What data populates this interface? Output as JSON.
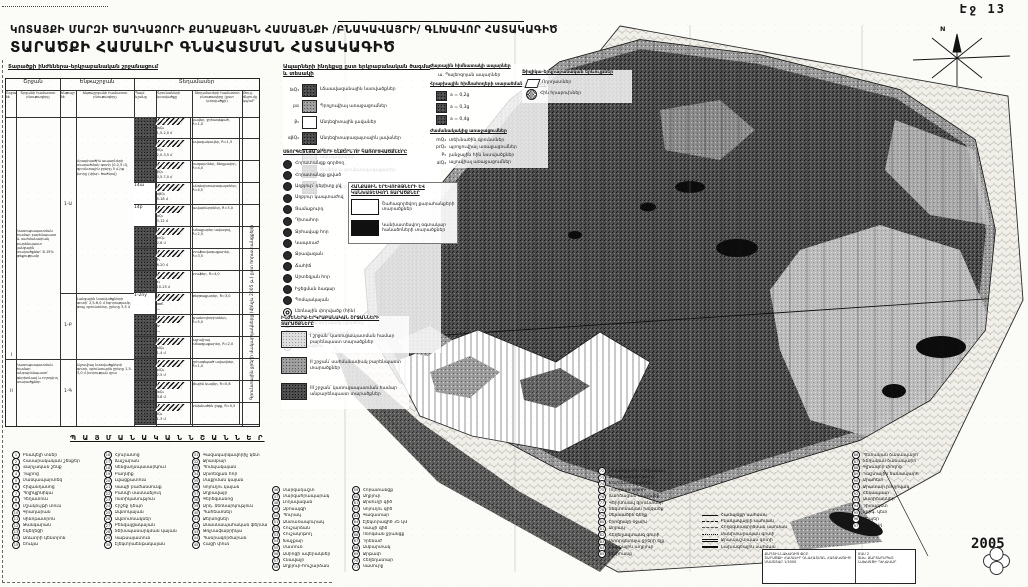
{
  "page": {
    "label": "Էջ 13",
    "year": "2005"
  },
  "header": {
    "line1": "ԿՈՏԱՅՔԻ ՄԱՐԶԻ ԾԱՂԿԱՁՈՐԻ ՔԱՂԱՔԱՅԻՆ ՀԱՄԱՅՆՔԻ /ԲՆԱԿԱՎԱՅՐԻ/ ԳԼԽԱՎՈՐ ՀԱՏԱԿԱԳԻԾ",
    "line2": "ՏԱՐԱԾՔԻ ՀԱՄԱԼԻՐ ԳՆԱՀԱՏՄԱՆ ՀԱՏԱԿԱԳԻԾ"
  },
  "table": {
    "title": "Տարածքի ինժեներա-երկրաբանական շրջանացում",
    "groups": [
      "Շրջան",
      "Ենթաշրջան",
      "Տեղամասեր"
    ],
    "cols": [
      "Շրջանի №",
      "Շրջանի համառոտ բնութագիրը",
      "Ենթաշրջանի №",
      "Ենթաշրջանի համառոտ բնութագիրը",
      "Պայմ. նշանը",
      "Գրունտների կտրվածքը",
      "Տեղամասերի համառոտ բնութագիրը (ըստ կտրվածքի)",
      "Թույլ. ճնշումը կգ/սմ²"
    ],
    "regions": [
      {
        "no": "I",
        "desc": "Կառուցապատման համար բարենպաստ և սահմանափակ բարենպաստ լանջային տարածքներ՝ 8-15% թեքությամբ"
      },
      {
        "no": "II",
        "desc": "Կառուցապատման համար անբարենպաստ՝ գերխոնավ և ողողվող տարածքներ"
      }
    ],
    "subs": [
      {
        "no": "1-Ա",
        "desc": "Հրաբխածին ապարների տարածման գոտի (0-2,5 մ), գրունտային ջրերը 5 մ-ից խորը (փխր. ծածկով)"
      },
      {
        "no": "1-Բ",
        "desc": "Լանջային նստվածքների գոտի՝ 2,5-6,0 մ հզորությամբ, թույլ գրունտներ, ջրերը 3-5 մ"
      },
      {
        "no": "1-Գ",
        "desc": "Ալյուվիալ նստվածքների գոտի, գրունտային ջրերը 1,5-3,0 մ խորության վրա"
      }
    ],
    "rows": [
      {
        "tone": "sw-dark",
        "mark": "",
        "idx": "laQ₄",
        "dim": "1,5-2,0 մ",
        "desc": "կավեր, ջրհագեցած, R=1,0"
      },
      {
        "tone": "sw-dark",
        "mark": "",
        "idx": "dQ₄",
        "dim": "2,0-3,5 մ",
        "desc": "ավազակավեր, R=1,5"
      },
      {
        "tone": "sw-dark",
        "mark": "",
        "idx": "βQ₃",
        "dim": "0,5-7,0 մ",
        "desc": "բազալտներ, ճեղքավոր, R=4,0"
      },
      {
        "tone": "mark",
        "mark": "14ա",
        "idx": "αβQ₂",
        "dim": "5-18 մ",
        "desc": "անդեզիտաբազալտներ, R=4,5"
      },
      {
        "tone": "mark",
        "mark": "14բ",
        "idx": "αQ₂",
        "dim": "3-12 մ",
        "desc": "լավաբեկորներ, R=3,0"
      },
      {
        "tone": "sw-dark",
        "mark": "",
        "idx": "prQ₄",
        "dim": "2-6 մ",
        "desc": "խճաքարեր ավազով, R=2,5"
      },
      {
        "tone": "sw-dark",
        "mark": "",
        "idx": "P₃",
        "dim": "6-20 մ",
        "desc": "տուֆավազաքարեր, R=3,5"
      },
      {
        "tone": "sw-dark",
        "mark": "",
        "idx": "τ₃",
        "dim": "10-25 մ",
        "desc": "տուֆեր, R=4,0"
      },
      {
        "tone": "mark",
        "mark": "1-2ny",
        "idx": "αвЄ",
        "dim": "—",
        "desc": "թերթաքարեր, R=3,0"
      },
      {
        "tone": "sw-dark",
        "mark": "",
        "idx": "Iv",
        "dim": "—",
        "desc": "գրանոդիորիտներ, R=5,0"
      },
      {
        "tone": "sw-dark",
        "mark": "",
        "idx": "alQ₄",
        "dim": "1-4 մ",
        "desc": "ալյուվիալ խճագլաքարեր, R=2,0"
      },
      {
        "tone": "sw-dark",
        "mark": "",
        "idx": "plQ₄",
        "dim": "2-5 մ",
        "desc": "ջրհագեցած ավազներ, R=1,0"
      },
      {
        "tone": "sw-dark",
        "mark": "",
        "idx": "laQ₃",
        "dim": "3-8 մ",
        "desc": "լճային կավեր, R=0,8"
      },
      {
        "tone": "sw-dark",
        "mark": "",
        "idx": "tQ₄",
        "dim": "1-3 մ",
        "desc": "տեխնածին լիցք, R=0,5"
      }
    ],
    "note": "Գրունտային ջրերի մակարդակները (մինչև 2005 թ.) ըստ հորատանցքերի"
  },
  "legend_rocks": {
    "title": "Ապարների ինդեքսը ըստ երկրաբանական ծագման և տեսակի",
    "items": [
      {
        "idx": "laQ₄",
        "tone": "sw-dark",
        "label": "Լճաավազանային նստվածքներ"
      },
      {
        "idx": "pα",
        "tone": "sw-mid",
        "label": "Պրոլյուվիալ առաջացումներ"
      },
      {
        "idx": "β₃",
        "tone": "sw-white",
        "label": "Անդեզիտային լավաներ"
      },
      {
        "idx": "αβQ₂",
        "tone": "sw-dark",
        "label": "Անդեզիտաբազալտային լավաներ"
      },
      {
        "idx": "αвЄ",
        "tone": "sw-mid",
        "label": "Մետամորֆացված թերթաքարեր և ավազաքարեր"
      },
      {
        "idx": "τ₃",
        "tone": "sw-dark",
        "label": "Տուֆեր և տուֆաավազաքարեր"
      },
      {
        "idx": "Iv",
        "tone": "sw-dark",
        "label": "Ինտրուզիվ ապարներ"
      }
    ]
  },
  "legend_underground": {
    "title": "ՍՏՈՐԳԵՏՆՅԱ ՋՐԵՐԻ ԵԼՔԵՐՆ ՈՒ ԿԱՌՈՒՑՎԱԾՔՆԵՐԸ",
    "items": [
      {
        "icon": "",
        "label": "Հորատանցք գործող"
      },
      {
        "icon": "",
        "label": "Հորատանցք լքված"
      },
      {
        "icon": "",
        "label": "Աղբյուր՝ դեբիտը լ/վ"
      },
      {
        "icon": "",
        "label": "Աղբյուր կապտաժով"
      },
      {
        "icon": "",
        "label": "Ցամաքուրդ"
      },
      {
        "icon": "",
        "label": "Դիտահոր"
      },
      {
        "icon": "",
        "label": "Ջրհավաք հոր"
      },
      {
        "icon": "",
        "label": "Կապտաժ"
      },
      {
        "icon": "",
        "label": "Ջրավազան"
      },
      {
        "icon": "",
        "label": "Ճահիճ"
      },
      {
        "icon": "",
        "label": "Արտեզյան հոր"
      },
      {
        "icon": "",
        "label": "Իջեցման ձագար"
      },
      {
        "icon": "",
        "label": "Պոմպակայան"
      },
      {
        "icon": "ring",
        "label": "Լեռնային փորվածք (հին)"
      },
      {
        "icon": "ring",
        "label": "Լեռնային փորվածք (գործող)"
      },
      {
        "icon": "ring",
        "label": "Լեռնահանքային շտոլնյա"
      },
      {
        "icon": "ring",
        "label": "Հանքափոս"
      }
    ]
  },
  "legend_regions": {
    "title": "ԻՆԺԵՆԵՐԱ-ԵՐԿՐԱԲԱՆԱԿԱՆ ՇՐՋԱՆՆԵՐԻ ՏԱՐԱԾՔՆԵՐԸ",
    "items": [
      {
        "tone": "sw-light",
        "label": "I շրջան՝ կառուցապատման համար բարենպաստ տարածքներ"
      },
      {
        "tone": "sw-mid",
        "label": "II շրջան՝ սահմանափակ բարենպաստ տարածքներ"
      },
      {
        "tone": "sw-dark",
        "label": "III շրջան՝ կառուցապատման համար անբարենպաստ տարածքներ"
      }
    ]
  },
  "legend_mid": {
    "rocks2_title": "Ժայռային հիմնատակի ապարներ",
    "rocks2_item": "ա. Պալեոզոյան ապարներ",
    "zones_title": "Հրաբխային հիմնահողերի տարածման գոտիներ",
    "zones": [
      "a = 0,2g",
      "a = 0,3g",
      "a = 0,4g"
    ],
    "modern_title": "Ժամանակակից առաջացումներ",
    "modern": [
      {
        "idx": "mQ₄",
        "label": "տեխնածին գրունտներ"
      },
      {
        "idx": "prQ₄",
        "label": "պրոլյուվիալ առաջացումներ"
      },
      {
        "idx": "P₃",
        "label": "լանջային հին նստվածքներ"
      },
      {
        "idx": "alQ₄",
        "label": "ալյուվիալ առաջացումներ"
      }
    ],
    "phys_title": "Ֆիզիկա-երկրաբանական երևույթներ",
    "phys_items": [
      "Ողողատներ",
      "Հին հրաբուխներ"
    ],
    "minerals_title": "ՀԱՆՔԱՅԻՆ ԵՐԵՎՈՒՅԹՆԵՐԻ ԵՎ ԿԱՆԽԱՏԵՍՎՈՂ ՏԱՐԱԾՔՆԵՐ",
    "minerals": [
      {
        "tone": "sw-white",
        "label": "Շահագործվող քարահանքերի տարածքներ"
      },
      {
        "tone": "sw-black",
        "label": "Կանխատեսվող օգտակար հանածոների տարածքներ"
      }
    ]
  },
  "bottom": {
    "header": "Պ Ա Յ Մ Ա Ն Ա Կ Ա Ն   Ն Շ Ա Ն Ն Ե Ր",
    "colA": [
      {
        "n": "1",
        "label": "Բնակելի տներ"
      },
      {
        "n": "2",
        "label": "Հասարակական շենքեր"
      },
      {
        "n": "3",
        "label": "Վարչական շենք"
      },
      {
        "n": "4",
        "label": "Դպրոց"
      },
      {
        "n": "5",
        "label": "Մանկապարտեզ"
      },
      {
        "n": "6",
        "label": "Հիվանդանոց"
      },
      {
        "n": "7",
        "label": "Պոլիկլինիկա"
      },
      {
        "n": "8",
        "label": "Դեղատուն"
      },
      {
        "n": "9",
        "label": "Մշակույթի տուն"
      },
      {
        "n": "10",
        "label": "Գրադարան"
      },
      {
        "n": "11",
        "label": "Կինոթատրոն"
      },
      {
        "n": "12",
        "label": "Թանգարան"
      },
      {
        "n": "13",
        "label": "Եկեղեցի"
      },
      {
        "n": "14",
        "label": "Առևտրի կենտրոն"
      },
      {
        "n": "15",
        "label": "Շուկա"
      }
    ],
    "colB": [
      {
        "n": "16",
        "label": "Հյուրանոց"
      },
      {
        "n": "17",
        "label": "Ճաշարան"
      },
      {
        "n": "18",
        "label": "Կենցաղսպասարկում"
      },
      {
        "n": "19",
        "label": "Բաղնիք"
      },
      {
        "n": "20",
        "label": "Լվացքատուն"
      },
      {
        "n": "21",
        "label": "Կապի բաժանմունք"
      },
      {
        "n": "22",
        "label": "Բանկի մասնաճյուղ"
      },
      {
        "n": "23",
        "label": "Ոստիկանություն"
      },
      {
        "n": "24",
        "label": "Հրշեջ դեպո"
      },
      {
        "n": "25",
        "label": "Ավտոկայան"
      },
      {
        "n": "26",
        "label": "Ավտոտնակներ"
      },
      {
        "n": "27",
        "label": "Բենզալցակայան"
      },
      {
        "n": "28",
        "label": "Տեխսպասարկման կայան"
      },
      {
        "n": "29",
        "label": "Կաթսայատուն"
      },
      {
        "n": "30",
        "label": "Էլեկտրաենթակայան"
      }
    ],
    "colC": [
      {
        "n": "31",
        "label": "Գազակարգավորիչ կետ"
      },
      {
        "n": "32",
        "label": "Ջրամբար"
      },
      {
        "n": "33",
        "label": "Պոմպակայան"
      },
      {
        "n": "34",
        "label": "Արտեզյան հոր"
      },
      {
        "n": "35",
        "label": "Մաքրման կայան"
      },
      {
        "n": "36",
        "label": "Կոյուղու կայան"
      },
      {
        "n": "37",
        "label": "Աղբավայր"
      },
      {
        "n": "38",
        "label": "Գերեզմանոց"
      },
      {
        "n": "39",
        "label": "Արդ. ձեռնարկություն"
      },
      {
        "n": "40",
        "label": "Պահեստներ"
      },
      {
        "n": "41",
        "label": "Ջերմոցներ"
      },
      {
        "n": "42",
        "label": "Անասնապահական ֆերմա"
      },
      {
        "n": "43",
        "label": "Թռչնաֆաբրիկա"
      },
      {
        "n": "44",
        "label": "Պանրագործարան"
      },
      {
        "n": "45",
        "label": "Հացի փուռ"
      }
    ],
    "colD": [
      {
        "n": "46",
        "label": "Մարզադաշտ"
      },
      {
        "n": "47",
        "label": "Մարզահրապարակ"
      },
      {
        "n": "48",
        "label": "Լողավազան"
      },
      {
        "n": "49",
        "label": "Զբոսայգի"
      },
      {
        "n": "50",
        "label": "Պուրակ"
      },
      {
        "n": "51",
        "label": "Անտառապուրակ"
      },
      {
        "n": "52",
        "label": "Հուշարձան"
      },
      {
        "n": "53",
        "label": "Հուշակոթող"
      },
      {
        "n": "54",
        "label": "Խաչքար"
      },
      {
        "n": "55",
        "label": "Մատուռ"
      },
      {
        "n": "56",
        "label": "Ամրոցի ավերակներ"
      },
      {
        "n": "57",
        "label": "Հնավայր"
      },
      {
        "n": "58",
        "label": "Աղբյուր-հուշարձան"
      }
    ],
    "colE": [
      {
        "n": "59",
        "label": "Հորատանցք"
      },
      {
        "n": "60",
        "label": "Աղբյուր"
      },
      {
        "n": "61",
        "label": "Ջրմուղի գիծ"
      },
      {
        "n": "62",
        "label": "Կոյուղու գիծ"
      },
      {
        "n": "63",
        "label": "Գազատար"
      },
      {
        "n": "64",
        "label": "Էլեկտրագիծ 35 կՎ"
      },
      {
        "n": "65",
        "label": "Կապի գիծ"
      },
      {
        "n": "66",
        "label": "Ոռոգման ջրանցք"
      },
      {
        "n": "67",
        "label": "Դրենաժ"
      },
      {
        "n": "68",
        "label": "Ամբարտակ"
      },
      {
        "n": "69",
        "label": "Ջրթափ"
      },
      {
        "n": "70",
        "label": "Հեղեղատար"
      },
      {
        "n": "71",
        "label": "Կամուրջ"
      }
    ],
    "colF": [
      {
        "n": "72",
        "label": "Սողանքային տեղամաս"
      },
      {
        "n": "73",
        "label": "Փլուզումների գոտի"
      },
      {
        "n": "74",
        "label": "Քարաթափումներ"
      },
      {
        "n": "75",
        "label": "Ողողման գոտի"
      },
      {
        "n": "76",
        "label": "Ճահճացած տարածք"
      },
      {
        "n": "77",
        "label": "Գերխոնավ գրունտներ"
      },
      {
        "n": "78",
        "label": "Տեկտոնական խզվածք"
      },
      {
        "n": "79",
        "label": "Սեյսմածին ճեղք"
      },
      {
        "n": "80",
        "label": "Էրոզիայի օջախ"
      },
      {
        "n": "81",
        "label": "Ձորակ"
      },
      {
        "n": "82",
        "label": "Հեղեղավտանգ գոտի"
      },
      {
        "n": "83",
        "label": "Ստորգետնյա ջրերի ելք"
      },
      {
        "n": "84",
        "label": "Հանքային աղբյուր"
      },
      {
        "n": "85",
        "label": "Քարհանք"
      }
    ],
    "colG": [
      {
        "sym": "ln-solid",
        "label": "Համայնքի սահման"
      },
      {
        "sym": "ln-dashed",
        "label": "Բնակավայրի սահման"
      },
      {
        "sym": "ln-dashdot",
        "label": "Հողօգտագործման սահման"
      },
      {
        "sym": "ln-dotted",
        "label": "Սանիտարական գոտի"
      },
      {
        "sym": "ln-double",
        "label": "Ջրապաշտպան գոտի"
      },
      {
        "sym": "ln-thick",
        "label": "Նախագծային սահման"
      }
    ],
    "colH": [
      {
        "n": "86",
        "label": "Պետական ճանապարհ"
      },
      {
        "n": "87",
        "label": "Տեղական ճանապարհ"
      },
      {
        "n": "88",
        "label": "Գլխավոր փողոց"
      },
      {
        "n": "89",
        "label": "Դաշտային ճանապարհ"
      },
      {
        "n": "90",
        "label": "Արահետ"
      },
      {
        "n": "91",
        "label": "Ջրատար խողովակ"
      },
      {
        "n": "92",
        "label": "Հենապատ"
      },
      {
        "n": "93",
        "label": "Աստիճաններ"
      },
      {
        "n": "94",
        "label": "Դիտակետ"
      },
      {
        "n": "95",
        "label": "Տրիգ. կետ"
      },
      {
        "n": "96",
        "label": "Ռեպեր"
      },
      {
        "n": "97",
        "label": "Ուղեկալ"
      }
    ]
  },
  "titleblock": {
    "left": [
      "ՔԱՂՇԻՆՆԱԽԱԳԻԾ ՓԲԸ",
      "ՏԱՐԱԾՔԻ ՀԱՄԱԼԻՐ ԳՆԱՀԱՏՄԱՆ ՀԱՏԱԿԱԳԻԾ",
      "ՄԱՍՇՏԱԲ 1:5000"
    ],
    "right": [
      "ՄԱՍ 2",
      "ԳԼԽ. ՃԱՐՏԱՐԱՊԵՏ",
      "ՆԱԽԱԳԾԻ ՂԵԿԱՎԱՐ"
    ]
  },
  "map": {
    "north_label": "N"
  }
}
